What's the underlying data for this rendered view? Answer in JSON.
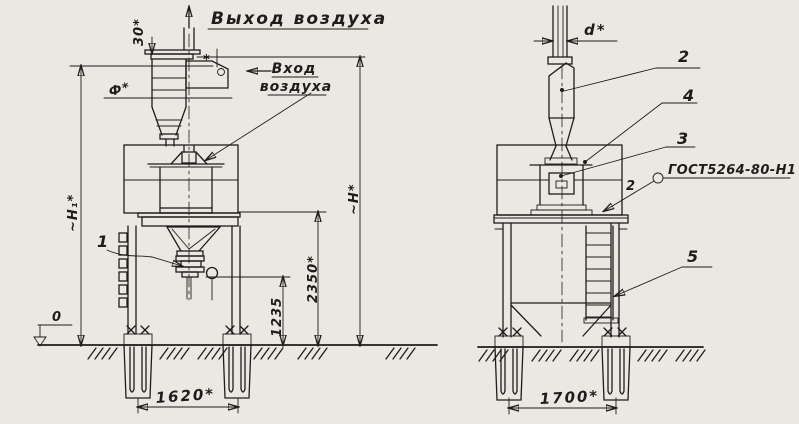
{
  "colors": {
    "paper": "#eae8e2",
    "ink": "#1f1d1a"
  },
  "front_view": {
    "air_outlet_label": "Выход воздуха",
    "air_inlet_line1": "Вход",
    "air_inlet_line2": "воздуха",
    "dim_offset_top": "30*",
    "dim_cyclone_diameter": "Ф*",
    "inlet_star": "*",
    "dim_height_h1": "~H₁*",
    "dim_height_h": "~H*",
    "dim_platform_2350": "2350*",
    "dim_outlet_1235": "1235",
    "datum_level": "0",
    "callout_unloader": "1",
    "dim_span_1620": "1620*"
  },
  "side_view": {
    "dim_pipe_d": "d*",
    "callout_cyclone": "2",
    "callout_chamber": "4",
    "callout_box": "3",
    "weld_qty": "2",
    "weld_spec": "ГОСТ5264-80-Н1",
    "callout_ladder": "5",
    "dim_span_1700": "1700*"
  }
}
